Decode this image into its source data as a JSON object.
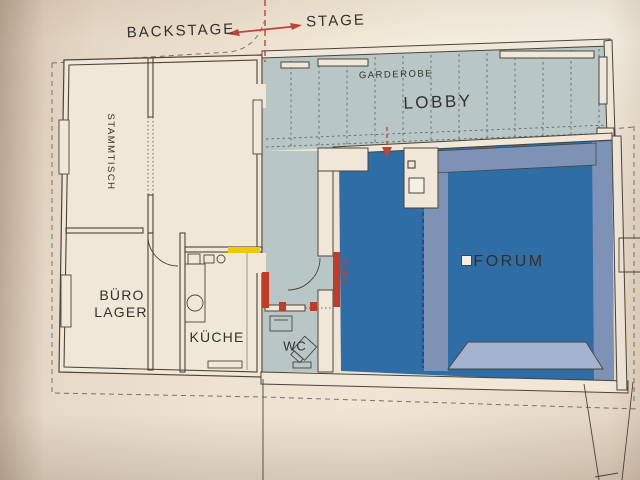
{
  "photo": {
    "description": "Photographed architectural floor plan of a venue on cream paper"
  },
  "labels": {
    "backstage": "BACKSTAGE",
    "stage": "STAGE",
    "garderobe": "GARDEROBE",
    "lobby": "LOBBY",
    "stammtisch": "STAMMTISCH",
    "buero": "BÜRO",
    "lager": "LAGER",
    "kueche": "KÜCHE",
    "wc": "WC",
    "expo": "EXPO",
    "forum": "FORUM"
  },
  "icons": {
    "stage_direction_arrow": "double-headed red arrow between BACKSTAGE and STAGE",
    "entry_arrow": "red dashed arrow pointing down into hall entry"
  },
  "colors": {
    "paper": "#e7dbca",
    "room": "#f1e7d8",
    "lobby": "#b8c7c6",
    "forum": "#2e6da6",
    "gallery": "#7e92b6",
    "stage_floor": "#a3b2ce",
    "ink": "#4b443a",
    "boundary": "#7b7166",
    "red": "#bf4438",
    "red_deep": "#c23a2a",
    "yellow": "#eecb00",
    "label_ink": "#35302a",
    "lobby_grid": "#5d6c6f",
    "navy": "#1c3f68",
    "white": "#f5f0e6"
  }
}
